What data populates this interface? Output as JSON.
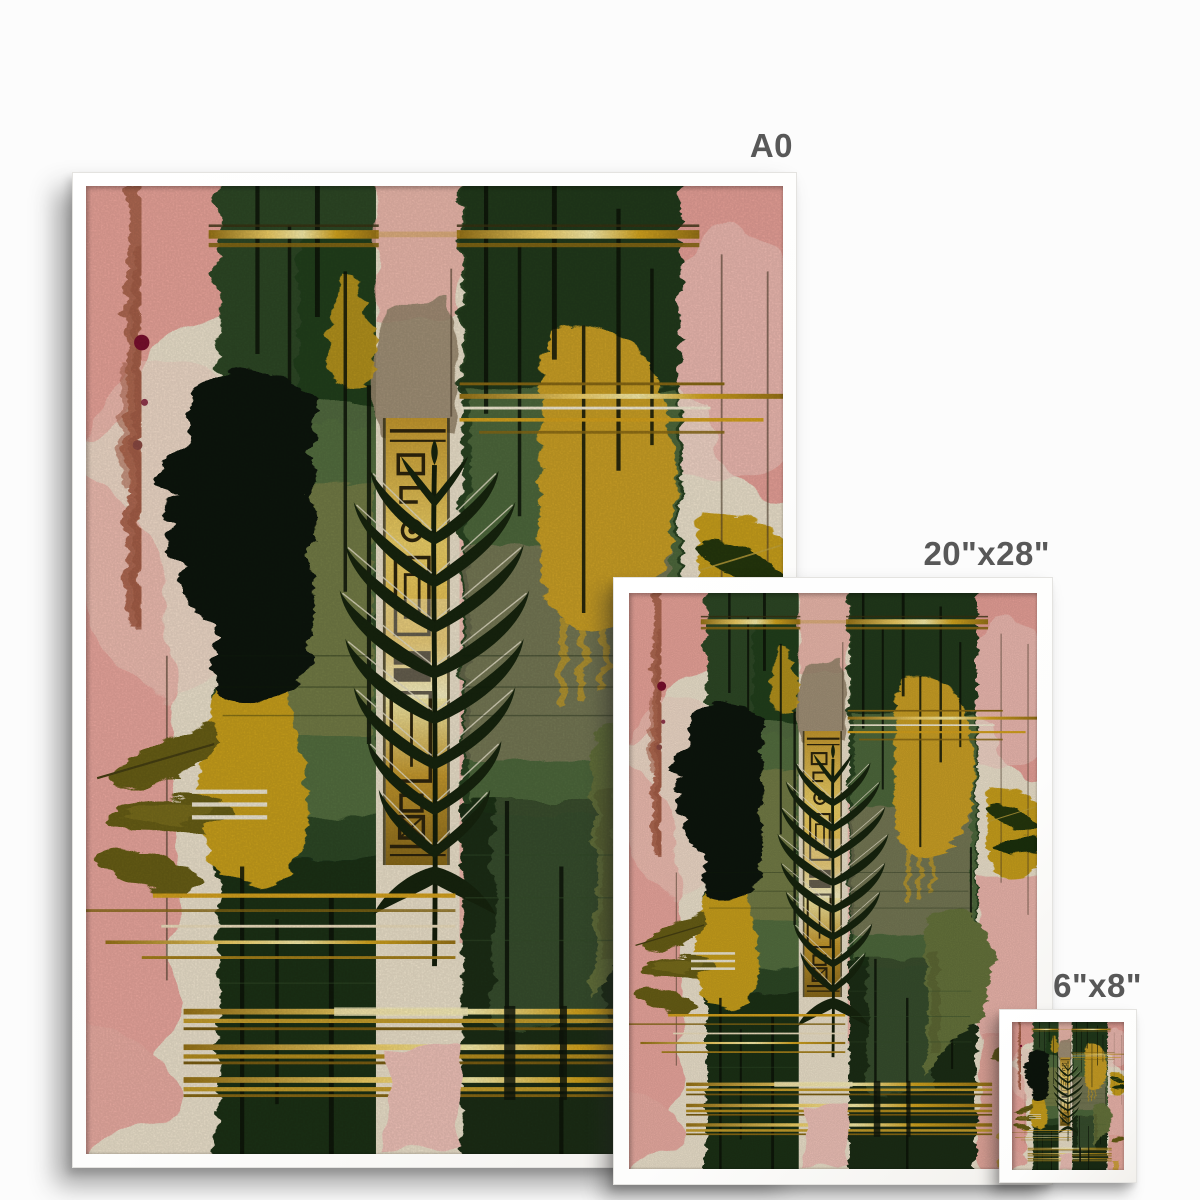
{
  "page": {
    "background": "#fcfcfc"
  },
  "size_labels": {
    "large": "A0",
    "medium": "20\"x28\"",
    "small": "6\"x8\"",
    "text_color": "#585858"
  },
  "frames": {
    "frame_color": "#ffffff",
    "count": 3
  },
  "artwork_palette": {
    "cream": "#f2e7d1",
    "pink": "#eca79d",
    "pale_pink": "#f6cfc3",
    "dark_green": "#2d4a27",
    "deep_green": "#17250e",
    "sage": "#5f7848",
    "gold_line": "#d9a51e",
    "bright_gold": "#f2d469",
    "mustard": "#cfa325",
    "tan": "#98876c",
    "terracotta": "#b26b52",
    "maroon": "#7c0f2e",
    "ink_black": "#0f160c",
    "olive_leaf": "#6b6018",
    "olive_face": "#68763d"
  }
}
